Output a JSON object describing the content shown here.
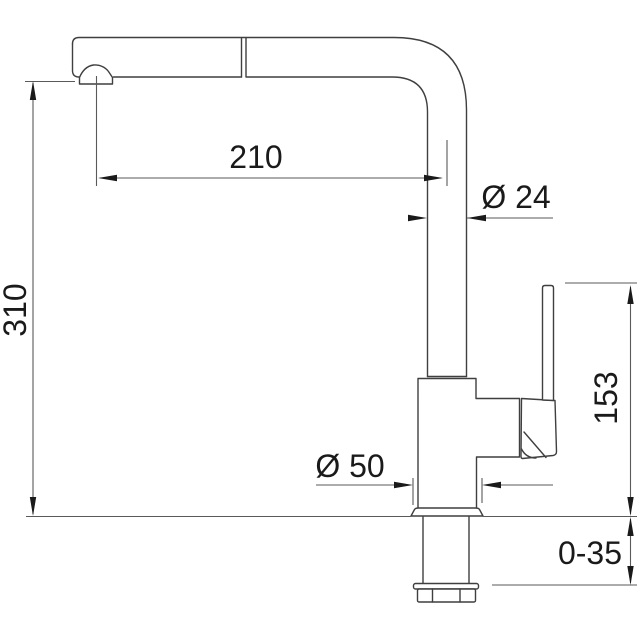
{
  "drawing": {
    "subject": "single-lever kitchen mixer tap with pull-out spout, side elevation with dimensions",
    "units": "mm",
    "dimensions": [
      {
        "id": "spout-reach",
        "label": "210",
        "value": 210,
        "orientation": "horizontal"
      },
      {
        "id": "pipe-diameter",
        "label": "Ø 24",
        "value": 24,
        "orientation": "horizontal"
      },
      {
        "id": "total-height",
        "label": "310",
        "value": 310,
        "orientation": "vertical"
      },
      {
        "id": "lever-height",
        "label": "153",
        "value": 153,
        "orientation": "vertical"
      },
      {
        "id": "base-diameter",
        "label": "Ø 50",
        "value": 50,
        "orientation": "horizontal"
      },
      {
        "id": "mounting-deck-thickness",
        "label": "0-35",
        "min": 0,
        "max": 35,
        "orientation": "vertical"
      }
    ],
    "colors": {
      "background": "#ffffff",
      "outline": "#3f3f3f",
      "dimension_line": "#5a5a5a",
      "text": "#1a1a1a"
    }
  }
}
